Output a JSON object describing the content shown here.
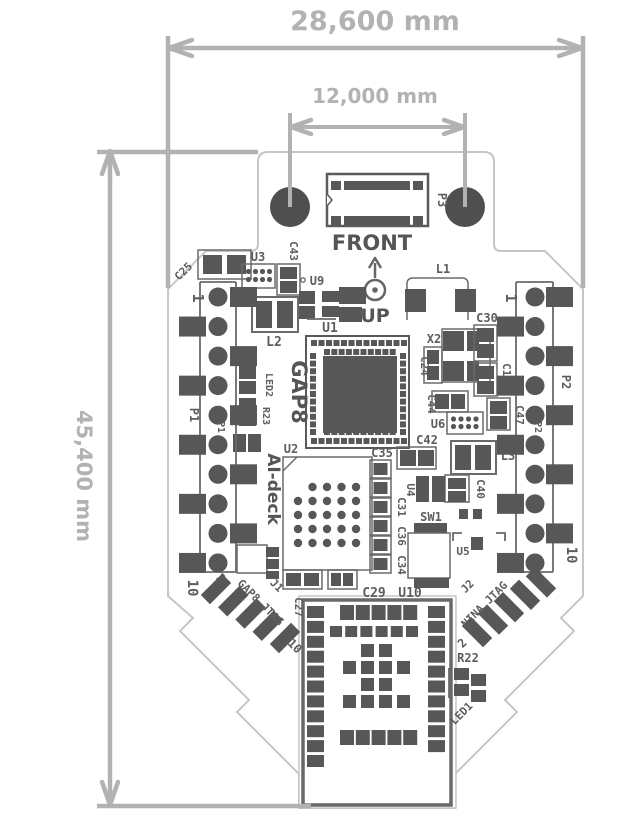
{
  "dimensions": {
    "width": "28,600 mm",
    "hole_spacing": "12,000 mm",
    "height": "45,400 mm"
  },
  "orientation": {
    "front": "FRONT",
    "up": "UP"
  },
  "silkscreen": {
    "soc_name": "GAP8",
    "deck_name": "AI-deck"
  },
  "headers": {
    "p1": {
      "ref": "P1",
      "pin1": "1",
      "pin10": "10"
    },
    "p2": {
      "ref": "P2",
      "pin1": "1",
      "pin10": "10"
    },
    "p3": {
      "ref": "P3"
    },
    "j1": {
      "ref": "J1",
      "name": "GAP8 JTAG",
      "pin2": "2",
      "pin10": "10"
    },
    "j2": {
      "ref": "J2",
      "name": "NINA JTAG",
      "pin2": "2",
      "pin10": "10"
    }
  },
  "refs": {
    "u1": "U1",
    "u2": "U2",
    "u3": "U3",
    "u4": "U4",
    "u5": "U5",
    "u6": "U6",
    "u8": "U8",
    "u9": "U9",
    "u10": "U10",
    "c18": "C18",
    "c24": "C24",
    "c25": "C25",
    "c27": "C27",
    "c29": "C29",
    "c30": "C30",
    "c31": "C31",
    "c34": "C34",
    "c35": "C35",
    "c36": "C36",
    "c40": "C40",
    "c42": "C42",
    "c43": "C43",
    "c44": "C44",
    "c47": "C47",
    "l1": "L1",
    "l2": "L2",
    "l3": "L3",
    "x2": "X2",
    "sw1": "SW1",
    "r22": "R22",
    "r23": "R23",
    "led1": "LED1",
    "led2": "LED2"
  }
}
